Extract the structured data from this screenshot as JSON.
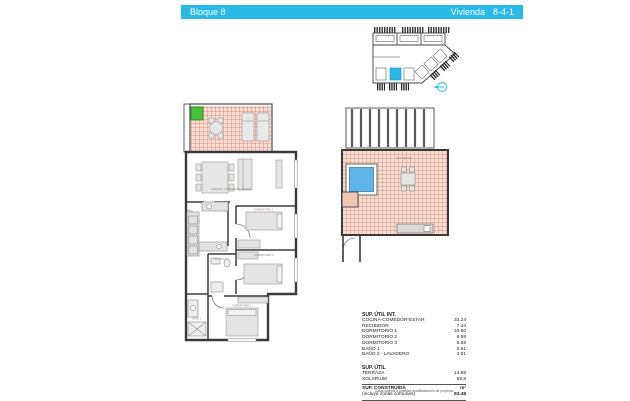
{
  "header": {
    "left": "Bloque 8",
    "right_label": "Vivienda",
    "right_value": "8-4-1",
    "bar_color": "#29b9e8"
  },
  "apartment_labels": {
    "living": "COCINA, COMEDOR, ESTAR",
    "hall": "RECIBIDOR",
    "bed2": "DORMITORIO 2",
    "bed3": "DORMITORIO 3",
    "bed1": "DORMITORIO 1",
    "bath1": "BAÑO 1"
  },
  "solarium_label": "SOLARIUM",
  "areas": {
    "int_title": "SUP. ÚTIL INT.",
    "int_rows": [
      {
        "label": "COCINA-COMEDOR-ESTAR",
        "value": "33.24"
      },
      {
        "label": "RECIBIDOR",
        "value": "7.44"
      },
      {
        "label": "DORMITORIO 1",
        "value": "10.50"
      },
      {
        "label": "DORMITORIO 2",
        "value": "6.59"
      },
      {
        "label": "DORMITORIO 3",
        "value": "6.59"
      },
      {
        "label": "BAÑO 1",
        "value": "3.91"
      },
      {
        "label": "BAÑO 2 - LAVADERO",
        "value": "3.91"
      }
    ],
    "ext_title": "SUP. ÚTIL",
    "ext_rows": [
      {
        "label": "TERRAZA",
        "value": "14.88"
      },
      {
        "label": "SOLARIUM",
        "value": "59.8"
      }
    ],
    "built_title": "SUP. CONSTRUIDA",
    "built_unit": "m²",
    "built_sub": "(incluye zonas comunes)",
    "built_value": "93.48"
  },
  "note": "Datos sujetos a posibles modificaciones de proyecto",
  "colors": {
    "accent_cyan": "#29b9e8",
    "tile_pink": "#f8ddd3",
    "pool_blue": "#5fb5e8",
    "unit_green": "#44c23c"
  }
}
